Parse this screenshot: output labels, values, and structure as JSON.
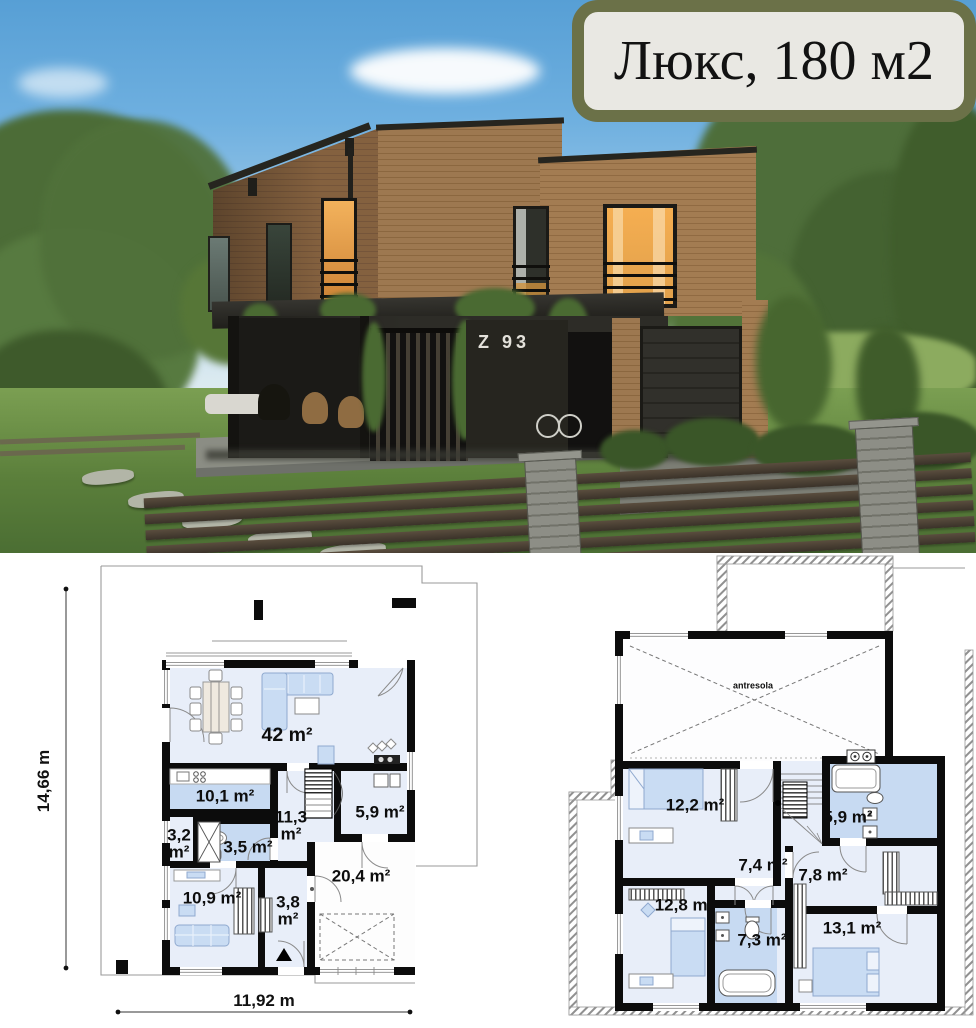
{
  "title_badge": {
    "label": "Люкс, 180 м2",
    "background": "#e9e8e3",
    "border_color": "#6b7148"
  },
  "photo": {
    "house_number": "Z 93"
  },
  "ground_floor": {
    "dim_height": "14,66 m",
    "dim_width": "11,92 m",
    "rooms": {
      "living": "42 m²",
      "kitchen": "10,1 m²",
      "wardrobe": "3,2 m²",
      "hall": "11,3 m²",
      "bathroom": "3,5 m²",
      "utility": "5,9 m²",
      "bedroom": "10,9 m²",
      "closet": "3,8 m²",
      "garage": "20,4 m²"
    }
  },
  "upper_floor": {
    "mezzanine": "antresola",
    "rooms": {
      "bedroom1": "12,2 m²",
      "bathroom1": "5,9 m²",
      "hall": "7,4 m²",
      "bedroom2": "12,8 m²",
      "bathroom2": "7,3 m²",
      "wardrobe_room": "7,8 m²",
      "bedroom3": "13,1 m²"
    }
  }
}
